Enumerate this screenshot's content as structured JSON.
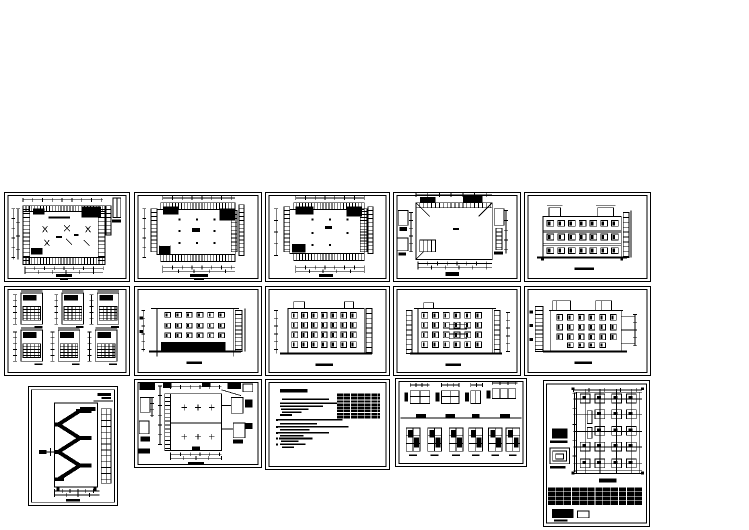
{
  "document": {
    "type": "architectural-cad-drawing-collage",
    "captions_present_but_illegible": true,
    "colors": {
      "paper": "#ffffff",
      "ink": "#000000"
    }
  },
  "panels": [
    {
      "id": "floor-plan-1",
      "kind": "floor-plan",
      "row": 1,
      "col": 1
    },
    {
      "id": "floor-plan-2",
      "kind": "floor-plan",
      "row": 1,
      "col": 2
    },
    {
      "id": "floor-plan-3",
      "kind": "floor-plan",
      "row": 1,
      "col": 3
    },
    {
      "id": "roof-plan",
      "kind": "roof-plan",
      "row": 1,
      "col": 4
    },
    {
      "id": "elevation-a",
      "kind": "building-elevation",
      "row": 1,
      "col": 5
    },
    {
      "id": "stair-wall-details",
      "kind": "detail-sheet",
      "row": 2,
      "col": 1
    },
    {
      "id": "elevation-b",
      "kind": "building-elevation",
      "row": 2,
      "col": 2
    },
    {
      "id": "elevation-c",
      "kind": "building-elevation",
      "row": 2,
      "col": 3
    },
    {
      "id": "elevation-d",
      "kind": "building-elevation",
      "row": 2,
      "col": 4
    },
    {
      "id": "elevation-e",
      "kind": "building-elevation",
      "row": 2,
      "col": 5
    },
    {
      "id": "stair-section",
      "kind": "stair-section",
      "row": 3,
      "col": 1
    },
    {
      "id": "roof-detail-plan",
      "kind": "detail-plan",
      "row": 3,
      "col": 2
    },
    {
      "id": "design-notes",
      "kind": "notes-and-schedule",
      "row": 3,
      "col": 3
    },
    {
      "id": "window-door-details",
      "kind": "detail-sheet",
      "row": 3,
      "col": 4
    },
    {
      "id": "column-layout-plan",
      "kind": "structural-plan",
      "row": 3,
      "col": 5
    }
  ]
}
